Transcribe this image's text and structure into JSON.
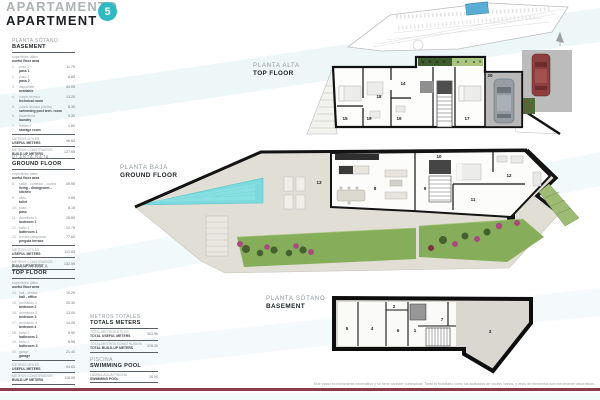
{
  "header": {
    "title_es": "APARTAMENTO",
    "title_en": "APARTMENT",
    "badge": "5"
  },
  "colors": {
    "accent": "#2fb9c3",
    "divider": "#8a3c4c",
    "pool": "#7cd9dd",
    "lawn": "#85ad5a"
  },
  "sidebar": {
    "sections": [
      {
        "title_es": "PLANTA SÓTANO",
        "title_en": "BASEMENT",
        "subtitle_es": "superficies útiles",
        "subtitle_en": "useful floor area",
        "rows": [
          {
            "num": "1.",
            "es": "paso 1",
            "en": "pass 1",
            "value": "11.75"
          },
          {
            "num": "2.",
            "es": "paso 2",
            "en": "pass 2",
            "value": "6.85"
          },
          {
            "num": "3.",
            "es": "disponible",
            "en": "available",
            "value": "44.05"
          },
          {
            "num": "4.",
            "es": "cuarto técnico",
            "en": "technical room",
            "value": "13.20"
          },
          {
            "num": "5.",
            "es": "cuarto técnico piscina",
            "en": "swimming pool tech. room",
            "value": "8.30"
          },
          {
            "num": "6.",
            "es": "lavandería",
            "en": "laundry",
            "value": "9.30"
          },
          {
            "num": "7.",
            "es": "trastero",
            "en": "storage room",
            "value": "1.60"
          }
        ],
        "totals": [
          {
            "es": "METROS ÚTILES",
            "en": "USEFUL METERS",
            "value": "96.65"
          },
          {
            "es": "METROS CONSTRUIDOS",
            "en": "BUILD-UP METERS",
            "value": "127.60"
          }
        ]
      },
      {
        "title_es": "PLANTA BAJA",
        "title_en": "GROUND FLOOR",
        "subtitle_es": "superficies útiles",
        "subtitle_en": "useful floor area",
        "rows": [
          {
            "num": "8.",
            "es": "salón - comedor - cocina",
            "en": "living - diningroom - kitchen",
            "value": "49.95"
          },
          {
            "num": "9.",
            "es": "aseo",
            "en": "toilet",
            "value": "3.65"
          },
          {
            "num": "10.",
            "es": "paso",
            "en": "pass",
            "value": "8.15"
          },
          {
            "num": "11.",
            "es": "dormitorio 1",
            "en": "bedroom 1",
            "value": "26.85"
          },
          {
            "num": "12.",
            "es": "baño 1",
            "en": "bathroom 1",
            "value": "12.75"
          },
          {
            "num": "13.",
            "es": "terraza pergolada",
            "en": "pergola terrace",
            "value": "77.60"
          }
        ],
        "totals": [
          {
            "es": "METROS ÚTILES",
            "en": "USEFUL METERS",
            "value": "112.65"
          },
          {
            "es": "METROS CONSTRUIDOS",
            "en": "BUILD-UP METERS",
            "value": "132.55"
          }
        ]
      },
      {
        "title_es": "PLANTA ALTA",
        "title_en": "TOP FLOOR",
        "subtitle_es": "superficies útiles",
        "subtitle_en": "useful floor area",
        "rows": [
          {
            "num": "14.",
            "es": "hall - oficina",
            "en": "hall - office",
            "value": "10.25"
          },
          {
            "num": "15.",
            "es": "dormitorio 2",
            "en": "bedroom 2",
            "value": "20.30"
          },
          {
            "num": "16.",
            "es": "dormitorio 3",
            "en": "bedroom 3",
            "value": "13.00"
          },
          {
            "num": "17.",
            "es": "dormitorio 4",
            "en": "bedroom 4",
            "value": "14.05"
          },
          {
            "num": "18.",
            "es": "baño 2",
            "en": "bathroom 2",
            "value": "6.90"
          },
          {
            "num": "19.",
            "es": "baño 3",
            "en": "bathroom 3",
            "value": "6.95"
          },
          {
            "num": "20.",
            "es": "garaje",
            "en": "garage",
            "value": "21.40"
          }
        ],
        "totals": [
          {
            "es": "METROS ÚTILES",
            "en": "USEFUL METERS",
            "value": "94.65"
          },
          {
            "es": "METROS CONSTRUIDOS",
            "en": "BUILD-UP METERS",
            "value": "118.05"
          }
        ]
      }
    ]
  },
  "totals_block": {
    "title_es": "METROS TOTALES",
    "title_en": "TOTALS METERS",
    "rows": [
      {
        "es": "TOTAL METROS ÚTILES",
        "en": "TOTAL USEFUL METERS",
        "value": "303.95"
      },
      {
        "es": "TOTAL METROS CONSTRUIDOS",
        "en": "TOTAL BUILD-UP METERS",
        "value": "378.20"
      }
    ]
  },
  "pool_block": {
    "title_es": "PISCINA",
    "title_en": "SWIMMING POOL",
    "rows": [
      {
        "es": "LÁMINA AGUA PISCINA",
        "en": "SWIMMING POOL",
        "value": "26.00"
      }
    ]
  },
  "plans": {
    "top": {
      "label_es": "PLANTA ALTA",
      "label_en": "TOP FLOOR",
      "rooms": [
        "14",
        "15",
        "16",
        "17",
        "18",
        "19",
        "20"
      ]
    },
    "ground": {
      "label_es": "PLANTA BAJA",
      "label_en": "GROUND FLOOR",
      "rooms": [
        "8",
        "9",
        "10",
        "11",
        "12",
        "13"
      ]
    },
    "basement": {
      "label_es": "PLANTA SÓTANO",
      "label_en": "BASEMENT",
      "rooms": [
        "1",
        "2",
        "3",
        "4",
        "5",
        "6",
        "7"
      ]
    }
  },
  "footer": {
    "disclaimer": "Este plano es meramente informativo y no tiene carácter contractual. Tanto el mobiliario como los acabados de cocina, baños, y resto de elementos son meramente decorativos."
  }
}
